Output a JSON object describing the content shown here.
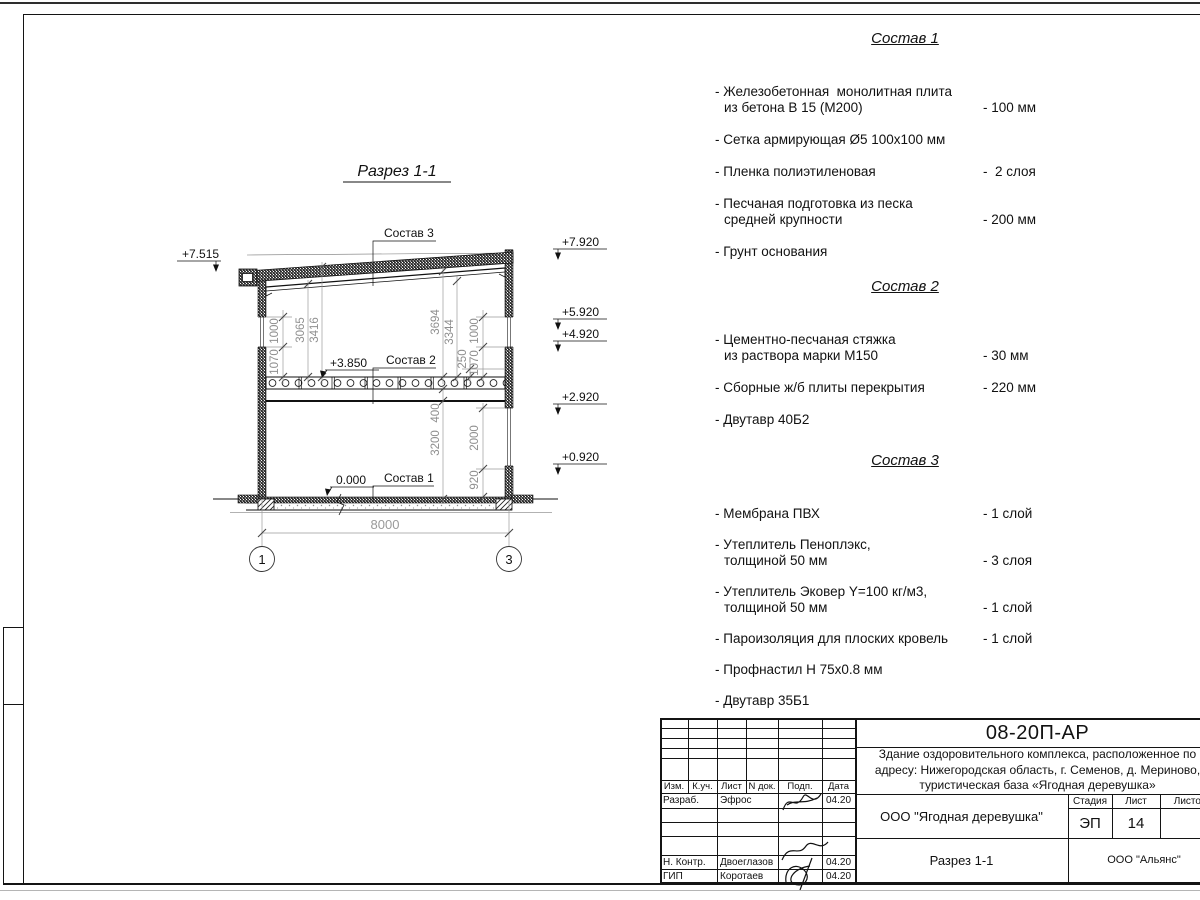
{
  "section": {
    "title": "Разрез 1-1",
    "labels": {
      "sostav1": "Состав 1",
      "sostav2": "Состав 2",
      "sostav3": "Состав 3",
      "level_mid": "+3.850",
      "level_zero": "0.000",
      "level_left": "+7.515"
    },
    "elevations": [
      "+7.920",
      "+5.920",
      "+4.920",
      "+2.920",
      "+0.920"
    ],
    "dimensions": {
      "span": "8000",
      "upper_left": [
        "1070",
        "1000",
        "3065",
        "3416"
      ],
      "upper_right": [
        "3694",
        "3344",
        "250",
        "1070",
        "1000"
      ],
      "lower_right": [
        "400",
        "3200",
        "2000",
        "920"
      ]
    },
    "axes": [
      "1",
      "3"
    ]
  },
  "compositions": [
    {
      "title": "Состав 1",
      "items": [
        {
          "lines": [
            "- Железобетонная  монолитная плита",
            "из бетона В 15 (М200)"
          ],
          "value": "- 100 мм"
        },
        {
          "lines": [
            "- Сетка армирующая Ø5 100х100 мм"
          ],
          "value": ""
        },
        {
          "lines": [
            "- Пленка полиэтиленовая"
          ],
          "value": "-  2 слоя"
        },
        {
          "lines": [
            "- Песчаная подготовка из песка",
            "средней крупности"
          ],
          "value": "- 200 мм"
        },
        {
          "lines": [
            "- Грунт основания"
          ],
          "value": ""
        }
      ]
    },
    {
      "title": "Состав 2",
      "items": [
        {
          "lines": [
            "- Цементно-песчаная стяжка",
            "из раствора марки М150"
          ],
          "value": "- 30 мм"
        },
        {
          "lines": [
            "- Сборные ж/б плиты перекрытия"
          ],
          "value": "- 220 мм"
        },
        {
          "lines": [
            "- Двутавр 40Б2"
          ],
          "value": ""
        }
      ]
    },
    {
      "title": "Состав 3",
      "items": [
        {
          "lines": [
            "- Мембрана ПВХ"
          ],
          "value": "- 1 слой"
        },
        {
          "lines": [
            "- Утеплитель Пеноплэкс,",
            "толщиной 50 мм"
          ],
          "value": "- 3 слоя"
        },
        {
          "lines": [
            "- Утеплитель Эковер Y=100 кг/м3,",
            "толщиной 50 мм"
          ],
          "value": "- 1 слой"
        },
        {
          "lines": [
            "- Пароизоляция для плоских кровель"
          ],
          "value": "- 1 слой"
        },
        {
          "lines": [
            "- Профнастил Н 75х0.8 мм"
          ],
          "value": ""
        },
        {
          "lines": [
            "- Двутавр 35Б1"
          ],
          "value": ""
        }
      ]
    }
  ],
  "titleblock": {
    "doc_number": "08-20П-АР",
    "object_lines": [
      "Здание оздоровительного комплекса, расположенное по",
      "адресу: Нижегородская область, г. Семенов, д. Мериново,",
      "туристическая база «Ягодная деревушка»"
    ],
    "org_row": "ООО \"Ягодная деревушка\"",
    "stage_label": "Стадия",
    "sheet_label": "Лист",
    "sheets_label": "Листов",
    "stage_value": "ЭП",
    "sheet_value": "14",
    "view_title": "Разрез 1-1",
    "company": "ООО \"Альянс\"",
    "header_cols": [
      "Изм.",
      "К.уч.",
      "Лист",
      "N док.",
      "Подп.",
      "Дата"
    ],
    "rows": [
      {
        "role": "Разраб.",
        "name": "Эфрос",
        "date": "04.20"
      },
      {
        "role": "",
        "name": "",
        "date": ""
      },
      {
        "role": "",
        "name": "",
        "date": ""
      },
      {
        "role": "",
        "name": "",
        "date": ""
      },
      {
        "role": "Н. Контр.",
        "name": "Двоеглазов",
        "date": "04.20"
      },
      {
        "role": "ГИП",
        "name": "Коротаев",
        "date": "04.20"
      }
    ]
  }
}
